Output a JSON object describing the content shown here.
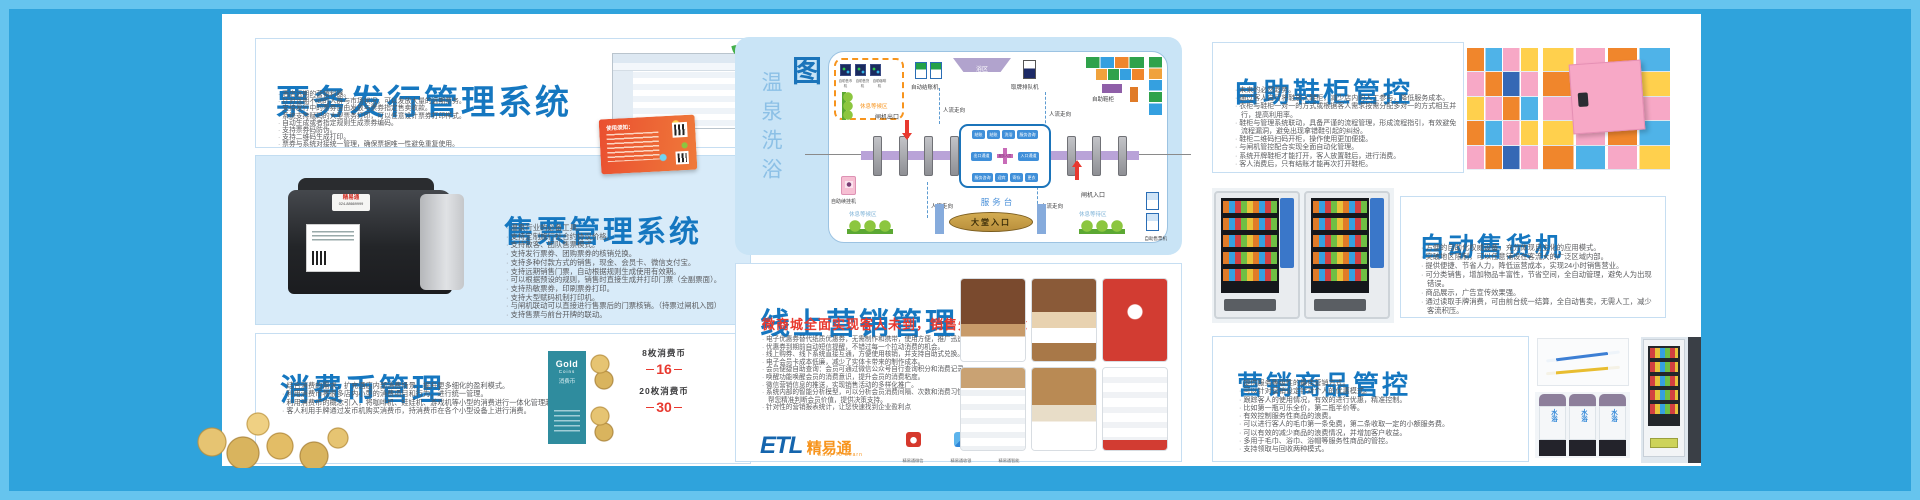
{
  "poster": {
    "ticketing": {
      "title": "票务发行管理系统",
      "bullets": [
        "酒店远期的营销利器。",
        "针对远期不同的人群与市场状况，可以发放大量的远期票务。",
        "支持发行中的票券自由发放与票券指定售卖收款。",
        "系统支持赋码的大型票务打印，可以任意设计票券打印样式。",
        "自动生成或者指定规则生成票券编码。",
        "支持票券码防伪。",
        "支持二维码生成打印。",
        "票券与系统对接统一管理，确保票据唯一性避免重复使用。"
      ],
      "ticket_note": "使用须知："
    },
    "sales": {
      "title": "售票管理系统",
      "bullets": [
        "温泉行业的必备工具。",
        "支持定制旅行社合约协议价格。",
        "支持散客、团队售票模式。",
        "支持发行票券、团购票券的核销兑换。",
        "支持多种付款方式的销售，现金、会员卡、微信支付宝。",
        "支持远期销售门票，自动根据规则生成使用有效期。",
        "可以根据预设的规则，销售时直接生成并打印门票（全副票面）。",
        "支持热敏票券，印刷票券打印。",
        "支持大型赋码机制打印机。",
        "与闸机联动可以直接进行售票后的门票核销。（持票过闸机入园）",
        "支持售票与前台开牌的联动。"
      ],
      "printer_brand": "精易通",
      "printer_phone": "024-88669999"
    },
    "coins": {
      "title": "消费币管理",
      "bullets": [
        "结合消费的需求，扩充酒店内部消费场景，提升更多细化的盈利模式。",
        "利用消费币将很多店内小型的消费项目和行为，进行统一管理。",
        "利用消费币的概念引入，将咖啡机、娃娃机、游戏机等小型的消费进行一体化管理起来。",
        "客人利用手牌通过发币机购买消费币，持消费币在各个小型设备上进行消费。"
      ],
      "card_en": "Gold",
      "card_en2": "Coins",
      "card_cn": "消费币",
      "prices": [
        {
          "qty": "8枚消费币",
          "price": "16"
        },
        {
          "qty": "20枚消费币",
          "price": "30"
        }
      ]
    },
    "diagram": {
      "title_light": "温泉洗浴",
      "title_bold": "自助化流程图",
      "labels": {
        "rest_top": "休息等候区",
        "auto_checkout": "自动结账机",
        "bath": "浴区",
        "queue": "取牌排队机",
        "shoe": "自助鞋柜",
        "gate_exit": "闸机出口",
        "gate_entry": "闸机入口",
        "people_flow": "人流走向",
        "service_desk": "服务台",
        "hall_entry": "大堂入口",
        "renew": "自助续挂机",
        "rest_bl": "休息等候区",
        "rest_br": "休息等待区",
        "ticket_kiosk": "自助售票机",
        "core": "服务人员",
        "chips_top": [
          "结账",
          "结账",
          "洗浴",
          "服务咨询"
        ],
        "chip_left": "出口通道",
        "chip_right": "入口通道",
        "chips_bottom": [
          "服务咨询",
          "迎宾",
          "寄存",
          "更衣"
        ],
        "minis": [
          "自助售币机",
          "自助售货机",
          "自助咖啡机"
        ]
      }
    },
    "marketing": {
      "title": "线上营销管理",
      "subtitle": "微商城全面实现客人未到，销售先行的理念",
      "bullets": [
        "电子优惠券替代纸质优惠券，无需制作和携带，使用方便，推广迅速",
        "优惠券到期前自动短信提醒，不错过每一个拉动消费的机会。",
        "线上购券、线下系统直接互通，方便使用核销，并支持自助式兑换。",
        "电子会员卡成本低廉，减少了实体卡带来的制作成本。",
        "会员便捷自助查询：会员可通过微信公众号自行查询积分和消费记录。",
        "唤醒功能唤醒会员的消费意识，提升会员的消费粘度。",
        "微信营销信息的推送，实现销售活动的多样化推广。",
        "系统内部的智能分析模型，可以分析会员消费间隔、次数和消费习惯，帮您精准判断会员价值，提供决策支持。",
        "针对性的营销报表统计，让您快速找到企业盈利点"
      ],
      "logo": {
        "en": "ETL",
        "cn": "精易通",
        "tag": "Easy To Learn"
      },
      "apps": [
        "精易通微信",
        "精易通收银",
        "精易通智能"
      ]
    },
    "shoe": {
      "title": "自助鞋柜管控",
      "bullets": [
        "未来的必然趋势。",
        "通过客人自行将鞋放入鞋柜，减少店内的人工参与，降低服务成本。",
        "衣柜与鞋柜一对一的方式或根据客人需求按需分配多对一的方式相互并行，提高利用率。",
        "鞋柜与管理系统联动，具备严谨的流程管理，形成流程指引，有效避免流程漏洞，避免出现拿错鞋引起的纠纷。",
        "鞋柜二维码扫码开柜，操作使用更加便捷。",
        "与闸机管控配合实现全面自动化管理。",
        "系统开牌鞋柜才能打开，客人放置鞋后，进行消费。",
        "客人消费后，只有结账才能再次打开鞋柜。"
      ]
    },
    "vending": {
      "title": "自动售货机",
      "bullets": [
        "方便的自助化权威设备，充分体现自主化的应用模式。",
        "突破地区限制，可以任意铺设在客流大的广泛区域内部。",
        "提供便捷、节省人力，降低运营成本，实现24小时销售营业。",
        "可分类销售，增加物品丰富性，节省空间，全自动管理，避免人为出现错误。",
        "商品展示，广告宣传效果强。",
        "通过读取手牌消费，可由前台统一结算，全自动售卖，无需人工，减少客流积压。"
      ]
    },
    "goods": {
      "title": "营销商品管控",
      "bullets": [
        "提供服务等级性的最佳营销方式。",
        "可以针对营销设定针对个人的优惠模式。",
        "跟踪客人的使用情况，有效的进行优惠，精准控制。",
        "比如第一瓶可乐全价，第二瓶半价等。",
        "有效控制服务性商品的浪费。",
        "可以进行客人的毛巾第一条免费，第二条收取一定的小额服务费。",
        "可以有效的减少商品的浪费情况，并增加客户收益。",
        "多用于毛巾、浴巾、浴帽等服务性商品的管控。",
        "支持领取与回收两种模式。"
      ],
      "bottle": "水浴"
    }
  }
}
